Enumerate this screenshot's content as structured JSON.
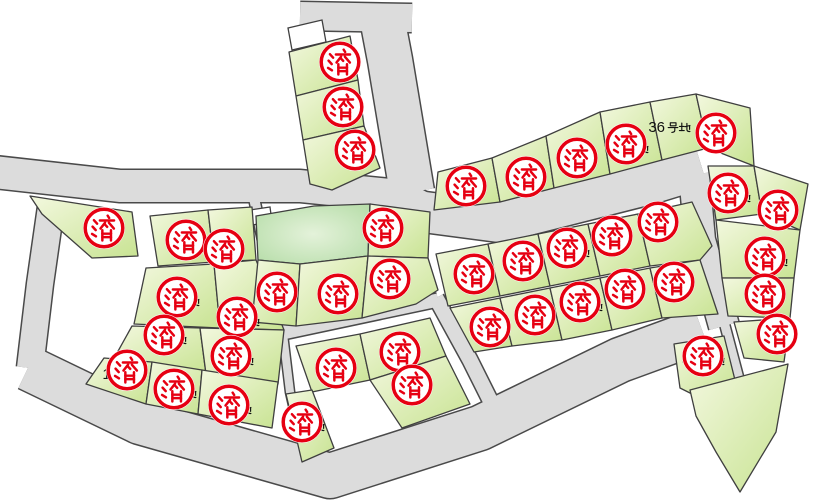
{
  "map": {
    "background": "#ffffff",
    "road": {
      "fill": "#dcdcdc",
      "outline": "#4a4a4a"
    },
    "lot": {
      "fill_light": "#f3f8df",
      "fill_dark": "#c8e392",
      "outline": "#3f3f3f"
    },
    "park": {
      "center": "#e4f2da",
      "edge": "#b2dba4"
    },
    "label_color": "#111111",
    "label_suffix": "号地",
    "stamp": {
      "text": "済",
      "color": "#e60012",
      "fill": "#ffffff",
      "meaning": "sold"
    },
    "sold_stamps": [
      {
        "x": 340,
        "y": 62
      },
      {
        "x": 343,
        "y": 107
      },
      {
        "x": 355,
        "y": 150
      },
      {
        "x": 104,
        "y": 228
      },
      {
        "x": 466,
        "y": 186
      },
      {
        "x": 526,
        "y": 177
      },
      {
        "x": 577,
        "y": 158
      },
      {
        "x": 626,
        "y": 144
      },
      {
        "x": 716,
        "y": 133
      },
      {
        "x": 474,
        "y": 274
      },
      {
        "x": 523,
        "y": 261
      },
      {
        "x": 567,
        "y": 248
      },
      {
        "x": 612,
        "y": 236
      },
      {
        "x": 658,
        "y": 222
      },
      {
        "x": 490,
        "y": 327
      },
      {
        "x": 535,
        "y": 315
      },
      {
        "x": 580,
        "y": 302
      },
      {
        "x": 625,
        "y": 289
      },
      {
        "x": 674,
        "y": 282
      },
      {
        "x": 383,
        "y": 228
      },
      {
        "x": 277,
        "y": 292
      },
      {
        "x": 338,
        "y": 294
      },
      {
        "x": 390,
        "y": 279
      },
      {
        "x": 186,
        "y": 240
      },
      {
        "x": 224,
        "y": 249
      },
      {
        "x": 177,
        "y": 297
      },
      {
        "x": 237,
        "y": 317
      },
      {
        "x": 164,
        "y": 335
      },
      {
        "x": 231,
        "y": 356
      },
      {
        "x": 127,
        "y": 370
      },
      {
        "x": 174,
        "y": 389
      },
      {
        "x": 229,
        "y": 405
      },
      {
        "x": 336,
        "y": 368
      },
      {
        "x": 400,
        "y": 352
      },
      {
        "x": 412,
        "y": 385
      },
      {
        "x": 302,
        "y": 422
      },
      {
        "x": 728,
        "y": 193
      },
      {
        "x": 778,
        "y": 210
      },
      {
        "x": 765,
        "y": 257
      },
      {
        "x": 765,
        "y": 294
      },
      {
        "x": 777,
        "y": 334
      },
      {
        "x": 703,
        "y": 356
      }
    ],
    "lot_labels": [
      {
        "number": "36",
        "suffix": "号地",
        "x": 666,
        "y": 127,
        "covered": false
      },
      {
        "number": "35",
        "suffix": "号地",
        "x": 624,
        "y": 148,
        "covered": true
      },
      {
        "number": "26",
        "suffix": "号地",
        "x": 565,
        "y": 252,
        "covered": true
      },
      {
        "number": "21",
        "suffix": "号地",
        "x": 578,
        "y": 306,
        "covered": true
      },
      {
        "number": "37",
        "suffix": "号地",
        "x": 726,
        "y": 197,
        "covered": true
      },
      {
        "number": "40",
        "suffix": "号地",
        "x": 763,
        "y": 261,
        "covered": true
      },
      {
        "number": "43",
        "suffix": "号地",
        "x": 700,
        "y": 360,
        "covered": true
      },
      {
        "number": "16",
        "suffix": "号地",
        "x": 175,
        "y": 301,
        "covered": true
      },
      {
        "number": "17",
        "suffix": "号地",
        "x": 235,
        "y": 321,
        "covered": true
      },
      {
        "number": "14",
        "suffix": "号地",
        "x": 162,
        "y": 339,
        "covered": true
      },
      {
        "number": "15",
        "suffix": "号地",
        "x": 229,
        "y": 360,
        "covered": true
      },
      {
        "number": "10",
        "suffix": "号地",
        "x": 120,
        "y": 374,
        "covered": true
      },
      {
        "number": "11",
        "suffix": "号地",
        "x": 172,
        "y": 393,
        "covered": true
      },
      {
        "number": "12",
        "suffix": "号地",
        "x": 227,
        "y": 409,
        "covered": true
      },
      {
        "number": "13",
        "suffix": "号地",
        "x": 300,
        "y": 426,
        "covered": true
      }
    ]
  }
}
